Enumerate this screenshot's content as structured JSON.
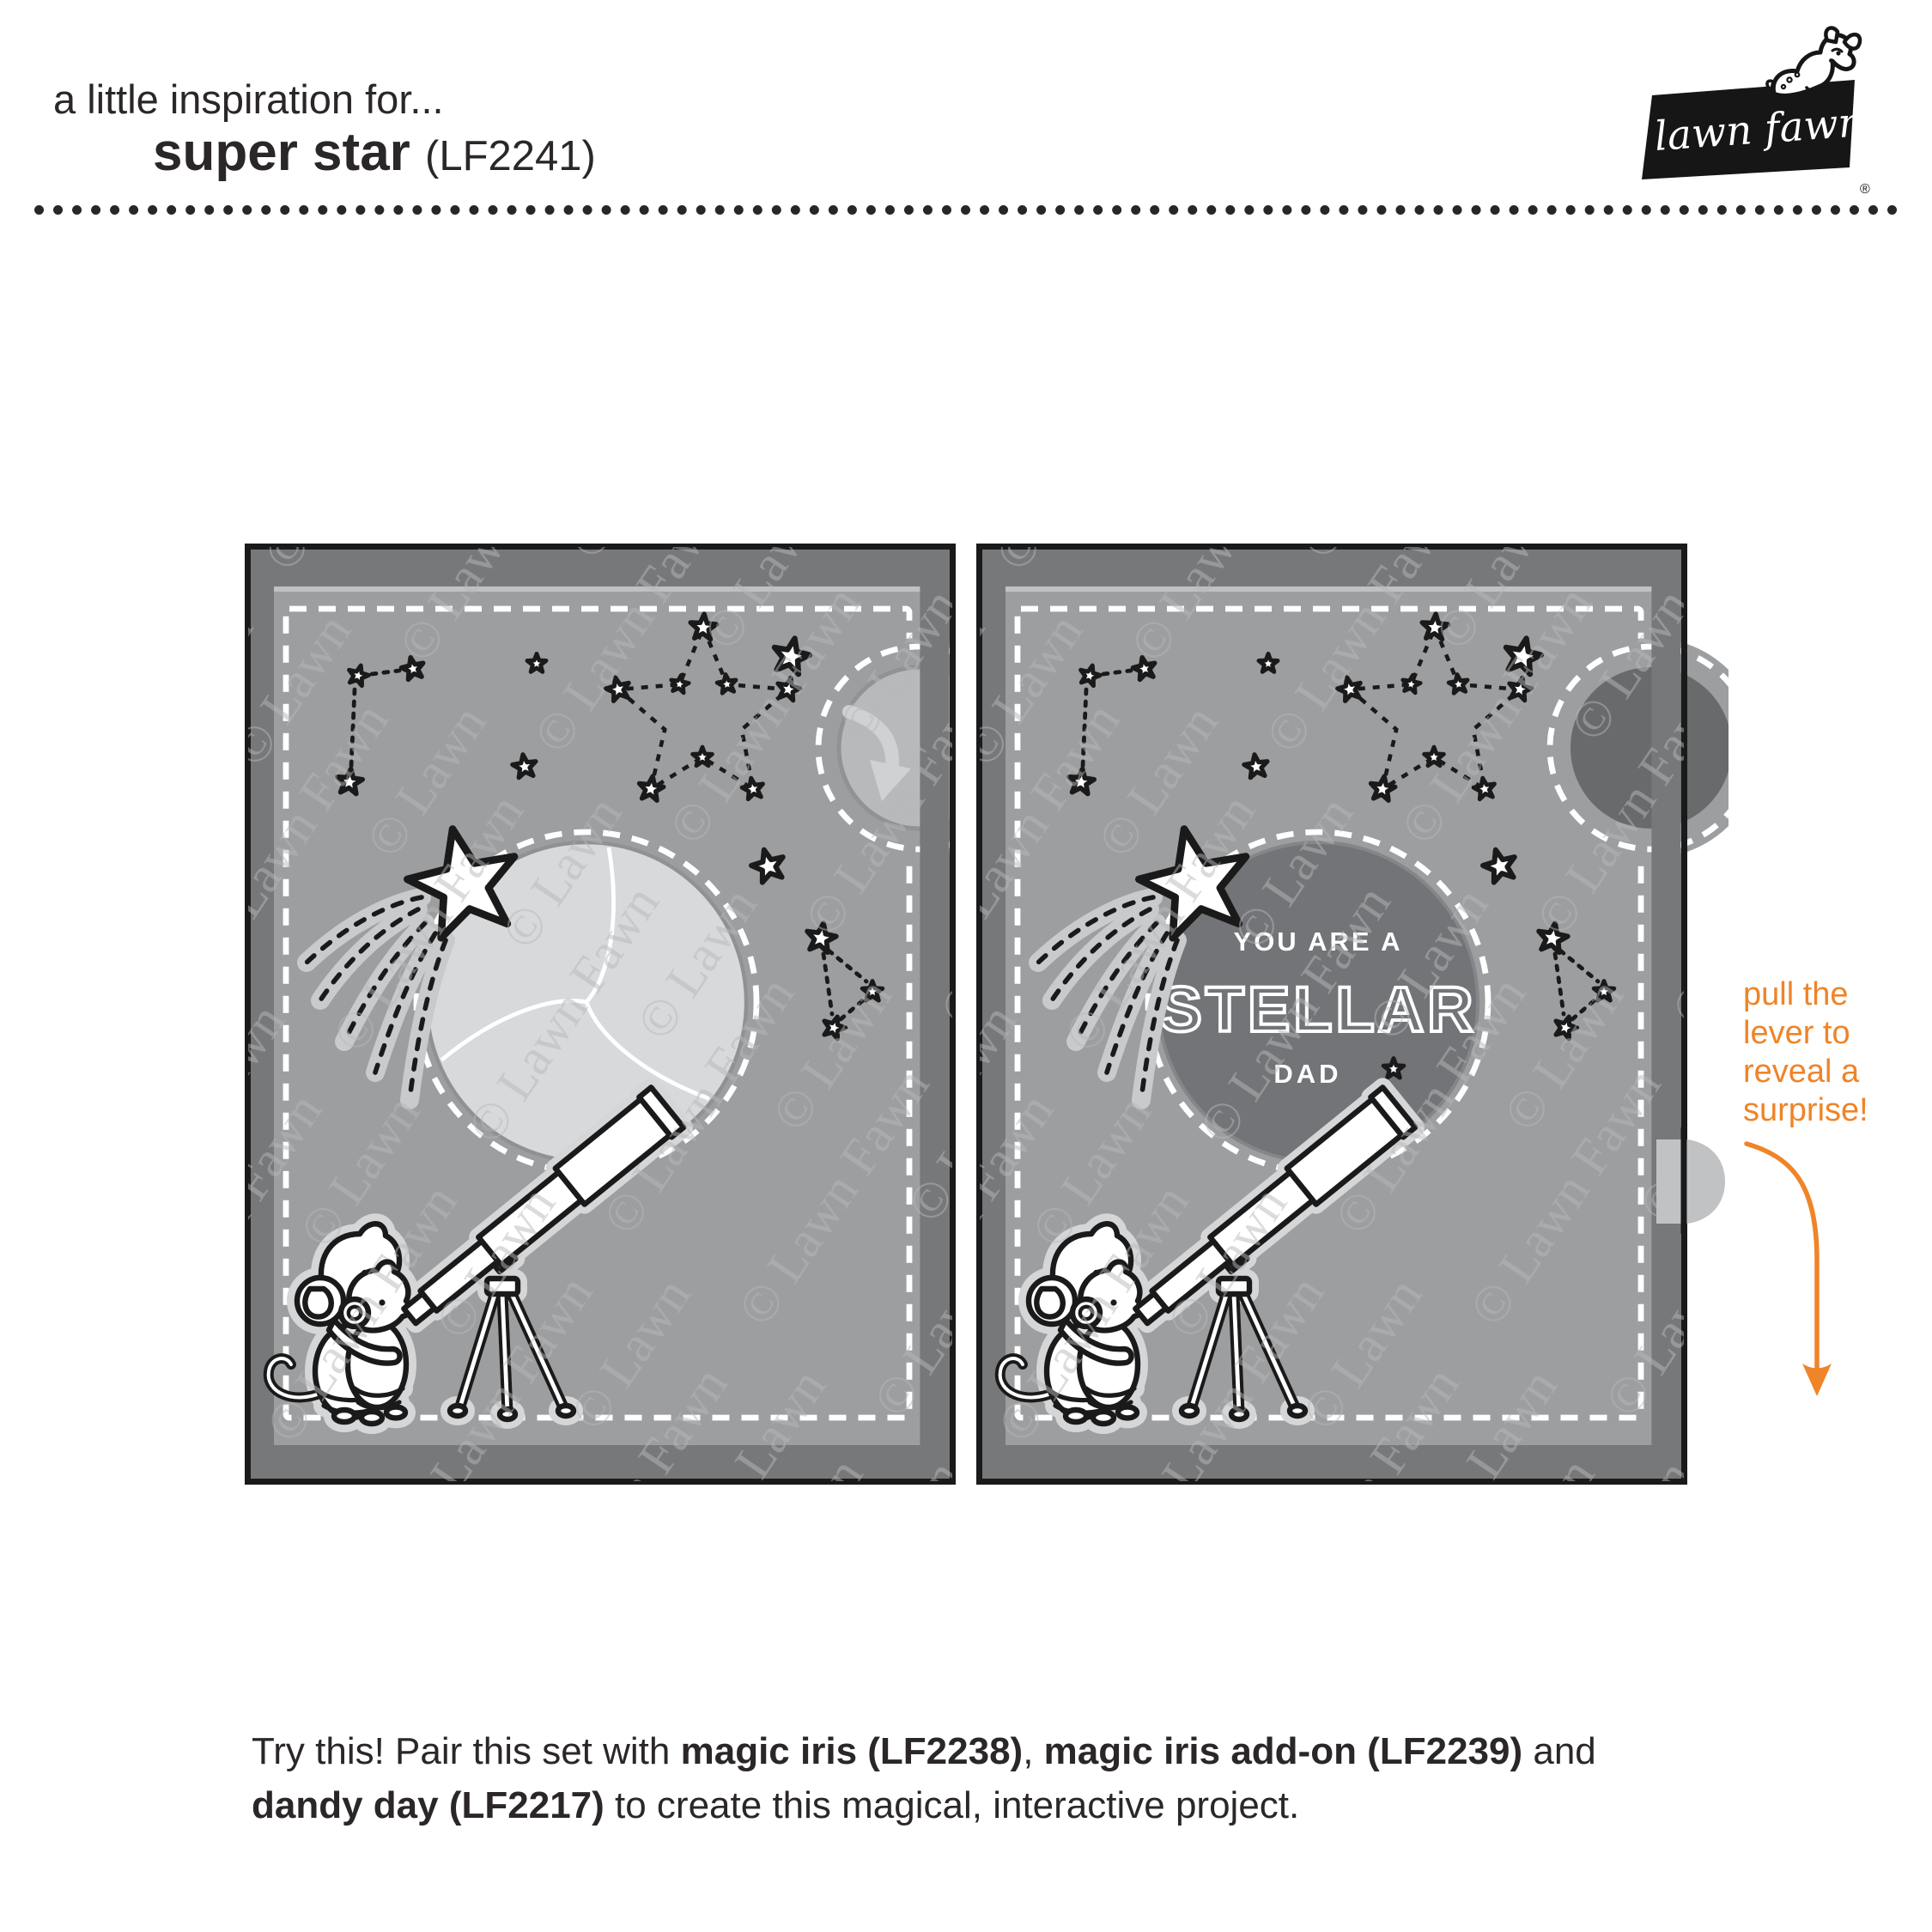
{
  "header": {
    "tagline": "a little inspiration for...",
    "product_name": "super star",
    "product_code": "(LF2241)"
  },
  "logo": {
    "script": "lawn fawn",
    "reg": "®"
  },
  "cards": {
    "left": {
      "iris_state": "closed"
    },
    "right": {
      "iris_state": "open",
      "sentiment": {
        "line1": "YOU ARE A",
        "word": "STELLAR",
        "line3": "DAD"
      }
    }
  },
  "watermark": {
    "text": "© Lawn Fawn"
  },
  "annotation": {
    "text": "pull the\nlever to\nreveal a\nsurprise!"
  },
  "footer": {
    "segments": [
      {
        "text": "Try this! Pair this set with "
      },
      {
        "text": "magic iris (LF2238)"
      },
      {
        "text": ", "
      },
      {
        "text": "magic iris add-on (LF2239)"
      },
      {
        "text": " and"
      },
      {
        "text": "dandy day (LF2217)"
      },
      {
        "text": " to create this magical, interactive project."
      }
    ]
  },
  "colors": {
    "accent_orange": "#ef8428",
    "card_frame": "#77787a",
    "card_panel": "#9c9ea0",
    "iris_light": "#d8d9db",
    "iris_dark": "#727477",
    "sticker_halo": "#d5d6d8"
  }
}
